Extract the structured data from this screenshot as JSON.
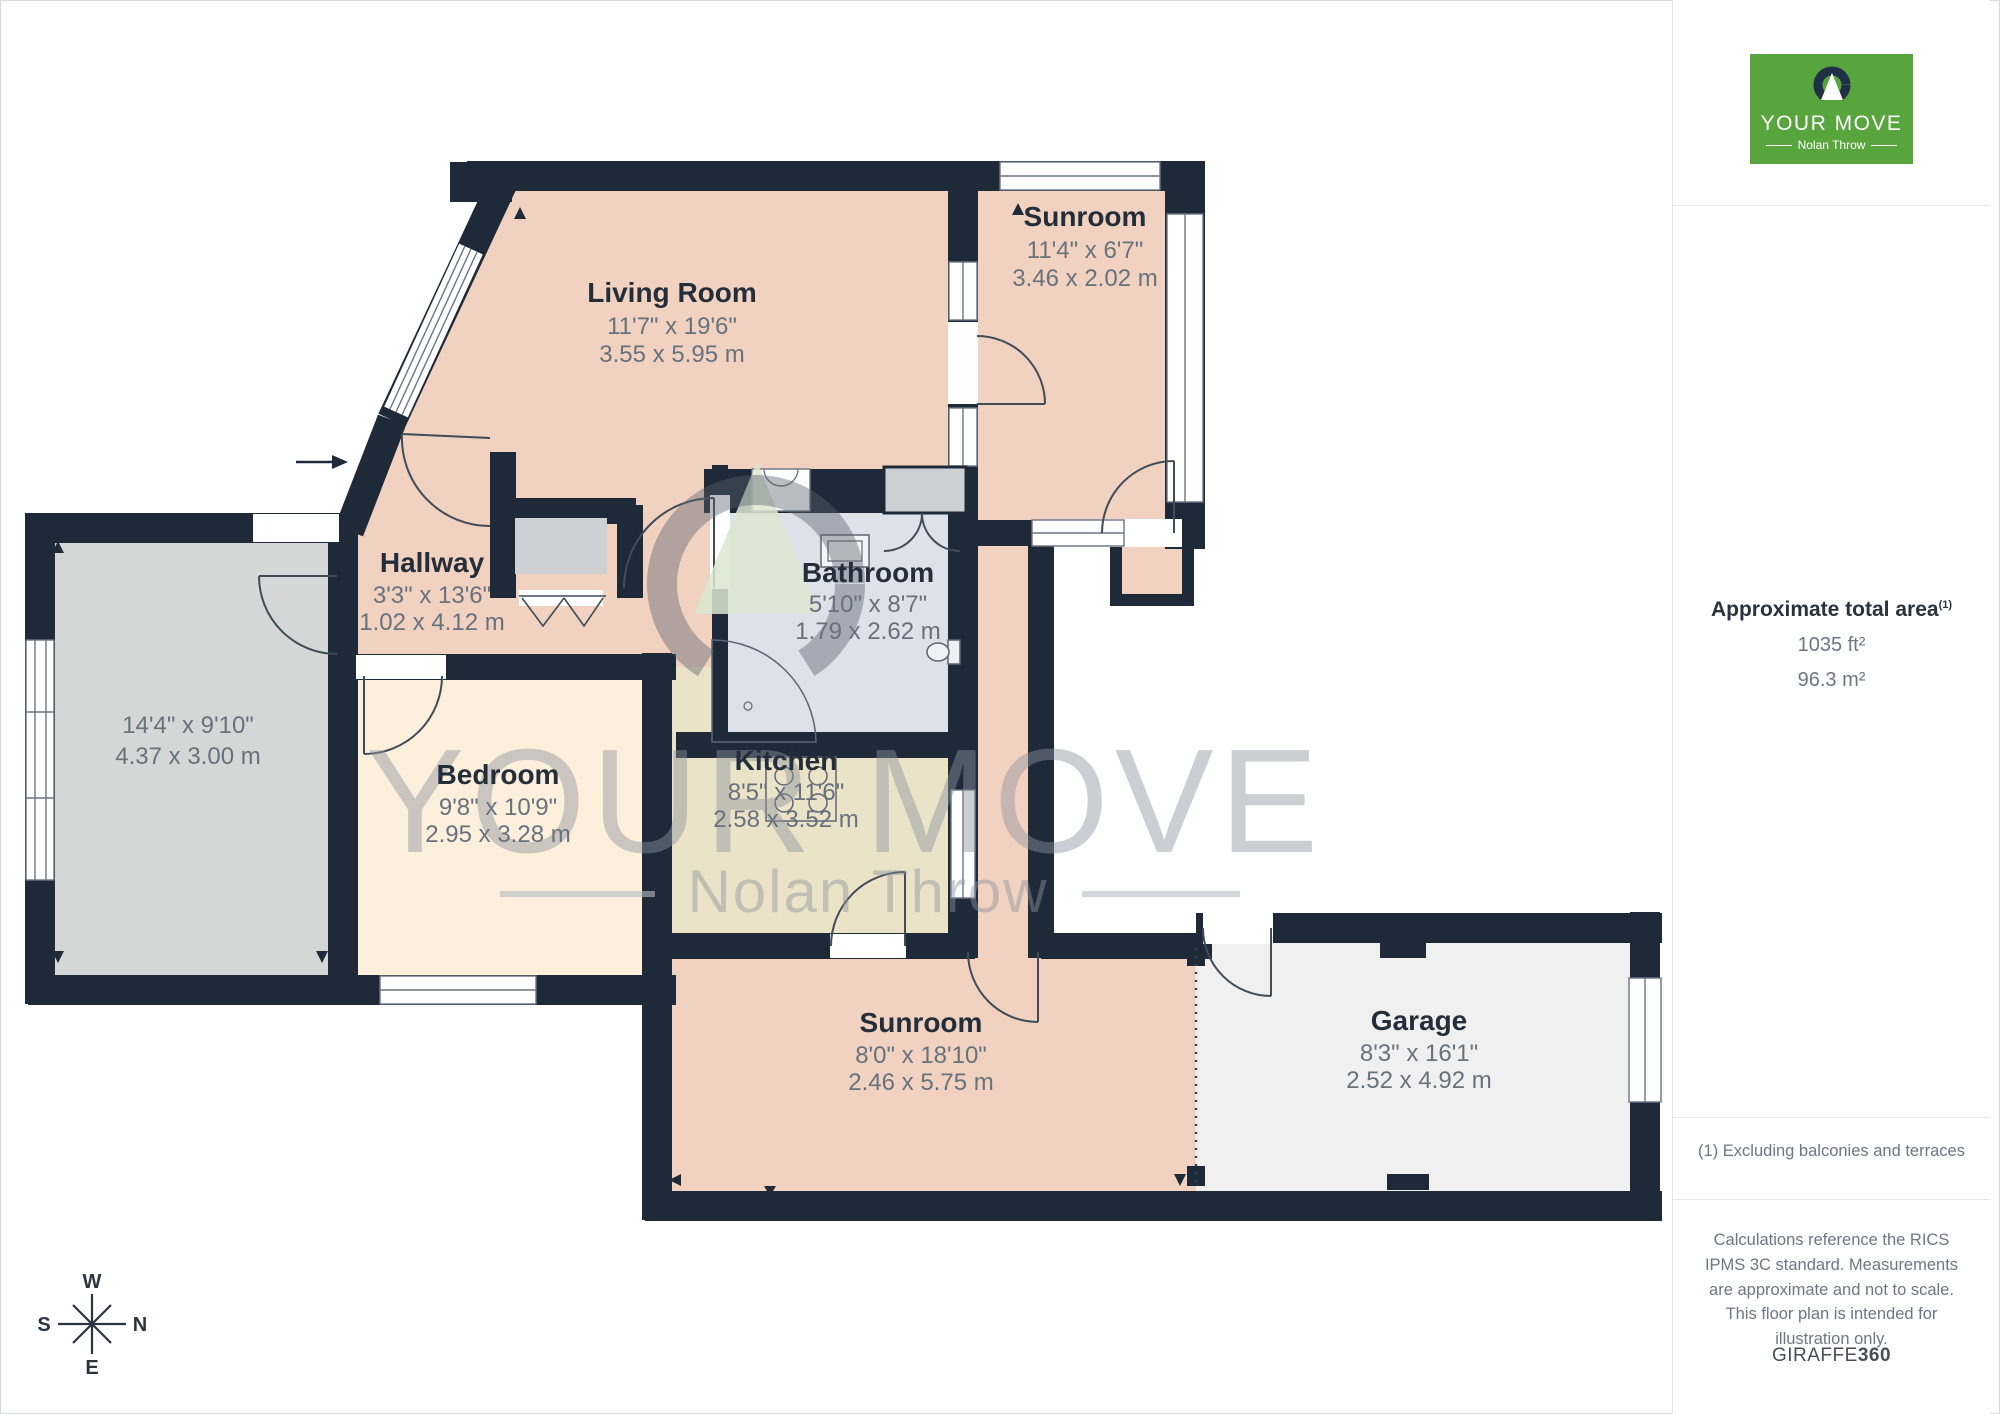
{
  "rooms": [
    {
      "name": "Living Room",
      "imperial": "11'7\" x 19'6\"",
      "metric": "3.55 x 5.95 m"
    },
    {
      "name": "Sunroom",
      "imperial": "11'4\" x 6'7\"",
      "metric": "3.46 x 2.02 m"
    },
    {
      "name": "Hallway",
      "imperial": "3'3\" x 13'6\"",
      "metric": "1.02 x 4.12 m"
    },
    {
      "name": "Bathroom",
      "imperial": "5'10\" x 8'7\"",
      "metric": "1.79 x 2.62 m"
    },
    {
      "imperial": "14'4\" x 9'10\"",
      "metric": "4.37 x 3.00 m"
    },
    {
      "name": "Bedroom",
      "imperial": "9'8\" x 10'9\"",
      "metric": "2.95 x 3.28 m"
    },
    {
      "name": "Kitchen",
      "imperial": "8'5\" x 11'6\"",
      "metric": "2.58 x 3.52 m"
    },
    {
      "name": "Sunroom",
      "imperial": "8'0\" x 18'10\"",
      "metric": "2.46 x 5.75 m"
    },
    {
      "name": "Garage",
      "imperial": "8'3\" x 16'1\"",
      "metric": "2.52 x 4.92 m"
    }
  ],
  "watermark": {
    "brand": "YOUR MOVE",
    "sub": "Nolan Throw"
  },
  "compass": {
    "w": "W",
    "n": "N",
    "s": "S",
    "e": "E"
  },
  "sidebar": {
    "logo_brand": "YOUR MOVE",
    "logo_sub": "Nolan Throw",
    "area_heading": "Approximate total area",
    "area_sup": "(1)",
    "area_imperial": "1035 ft²",
    "area_metric": "96.3 m²",
    "footnote": "(1) Excluding balconies and terraces",
    "disclaimer": "Calculations reference the RICS IPMS 3C standard. Measurements are approximate and not to scale. This floor plan is intended for illustration only.",
    "credit_brand": "GIRAFFE",
    "credit_bold": "360"
  },
  "colors": {
    "wall": "#1e2a38",
    "accent_green": "#58a43d"
  }
}
